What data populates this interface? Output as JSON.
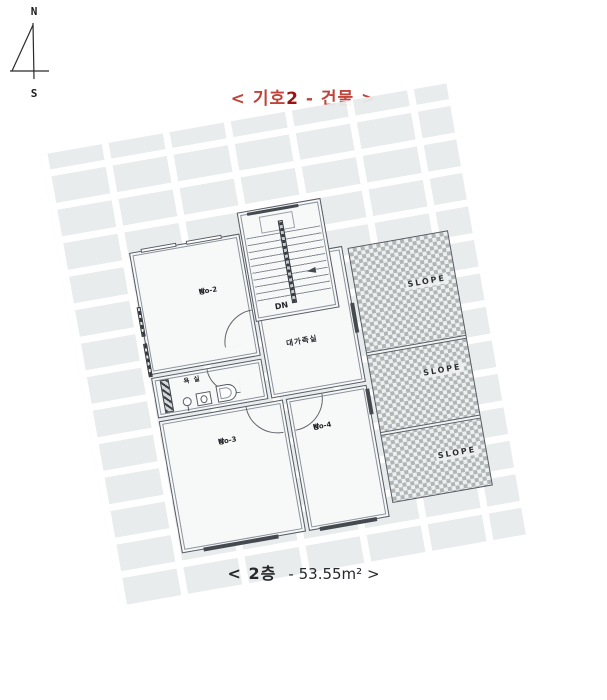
{
  "compass": {
    "north": "N",
    "south": "S"
  },
  "title": {
    "prefix": "< 기호",
    "number": "2",
    "suffix": " - 건물 >"
  },
  "floor_plan": {
    "rooms": {
      "room_no2": {
        "line1": "방",
        "line2": "No-2"
      },
      "room_no3": {
        "line1": "방",
        "line2": "No-3"
      },
      "room_no4": {
        "line1": "방",
        "line2": "No-4"
      },
      "family_room": "대가족실",
      "bathroom": "욕 실",
      "stairs_direction": "DN"
    },
    "slope_labels": [
      "SLOPE",
      "SLOPE",
      "SLOPE"
    ]
  },
  "caption": {
    "floor": "< 2층",
    "area": "- 53.55m² >"
  },
  "colors": {
    "title_red": "#c0443c",
    "title_red_bold": "#9b130f",
    "wall_line": "#565b63",
    "tile_fill": "#e8ebed",
    "slope_check": "#b0b5b7"
  }
}
